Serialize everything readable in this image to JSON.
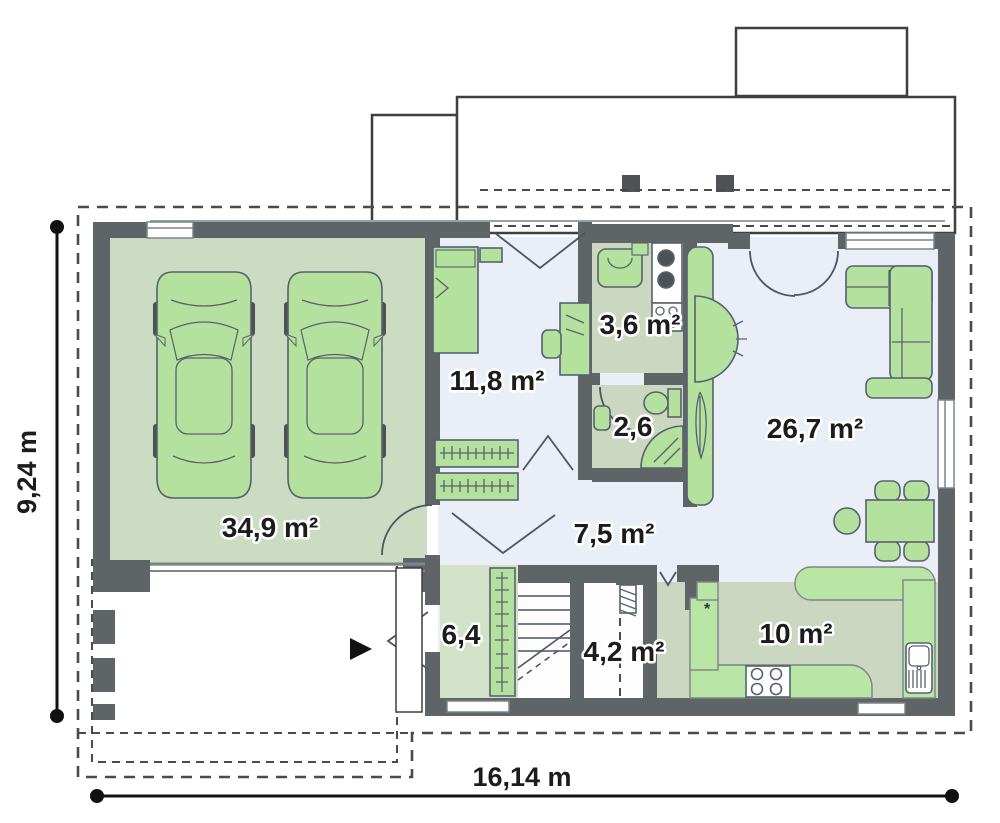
{
  "plan_title": "single-storey-floor-plan",
  "rooms": [
    {
      "id": "garage",
      "area": "34,9 m²"
    },
    {
      "id": "office-bedroom",
      "area": "11,8 m²"
    },
    {
      "id": "utility",
      "area": "3,6 m²"
    },
    {
      "id": "wc",
      "area": "2,6"
    },
    {
      "id": "living-room",
      "area": "26,7 m²"
    },
    {
      "id": "hall",
      "area": "7,5 m²"
    },
    {
      "id": "vestibule",
      "area": "6,4"
    },
    {
      "id": "storage-under-stairs",
      "area": "4,2 m²"
    },
    {
      "id": "kitchen",
      "area": "10 m²"
    }
  ],
  "dimensions": {
    "height_label": "9,24 m",
    "width_label": "16,14 m"
  },
  "colors": {
    "wall": "#5f6467",
    "wall_dark": "#4e5254",
    "floor_garage": "#ccdcc3",
    "floor_blue": "#e9eef7",
    "floor_sage": "#cbd7c0",
    "floor_vest": "#d2e1c7",
    "furniture": "#b5e19e",
    "furniture_bright": "#b9e6a4",
    "outline_dark": "#3f3f3f",
    "outline_mid": "#7d848a",
    "outline_furn": "#57616e",
    "outline_door": "#4b5563",
    "thin": "#9aa0a4",
    "dash": "#4b4b4b",
    "label": "#1c1c1c"
  }
}
